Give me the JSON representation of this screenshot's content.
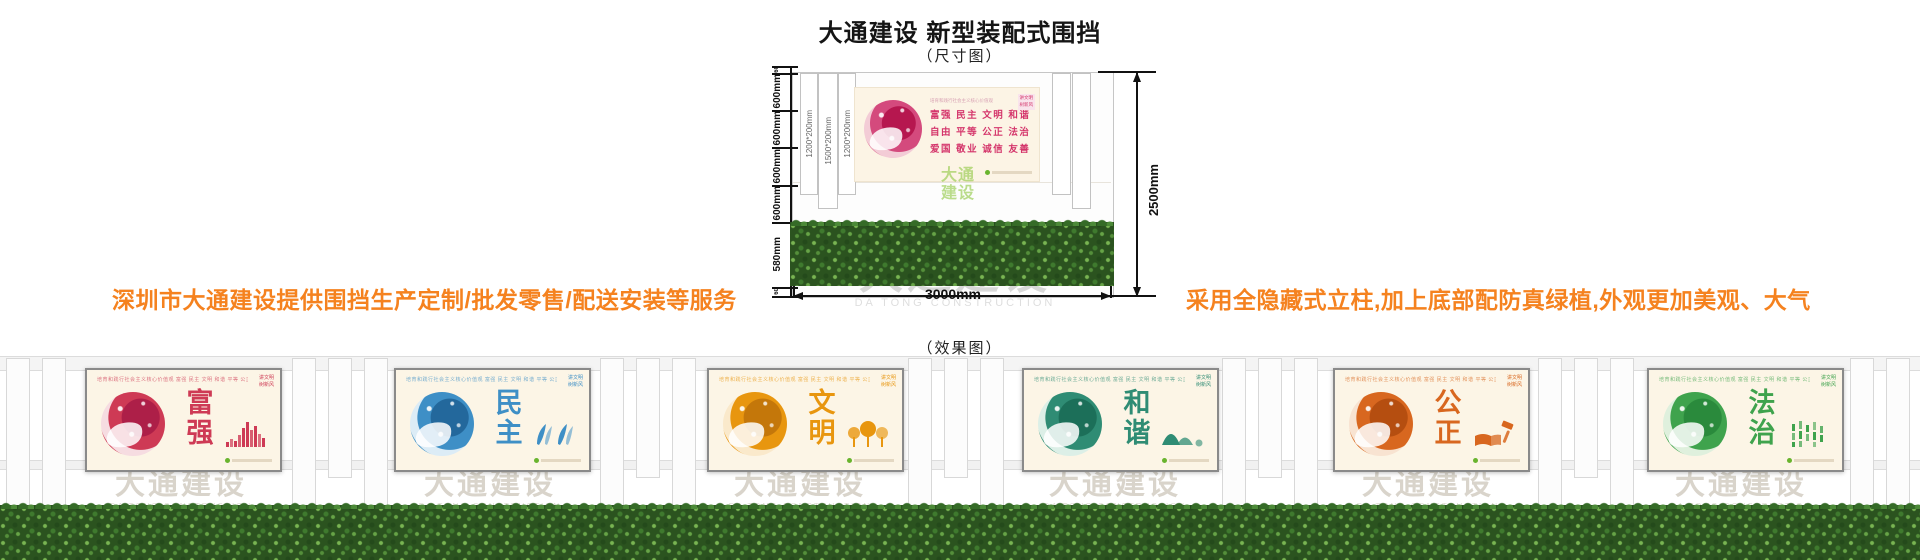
{
  "header": {
    "title": "大通建设 新型装配式围挡",
    "dimension_caption": "（尺寸图）",
    "effect_caption": "（效果图）"
  },
  "marketing": {
    "left_note": "深圳市大通建设提供围挡生产定制/批发零售/配送安装等服务",
    "right_note": "采用全隐藏式立柱,加上底部配防真绿植,外观更加美观、大气",
    "accent_color": "#F5821F"
  },
  "diagram": {
    "total_height": "2500mm",
    "total_width": "3000mm",
    "left_segments": [
      "60",
      "600mm",
      "600mm",
      "600mm",
      "600mm",
      "580mm",
      "60"
    ],
    "column_labels": [
      "1200*200mm",
      "1500*200mm",
      "1200*200mm"
    ],
    "poster": {
      "slogan_header": "培育和践行社会主义核心价值观",
      "value_rows": [
        "富强  民主  文明  和谐",
        "自由  平等  公正  法治",
        "爱国  敬业  诚信  友善"
      ],
      "chip_lines": [
        "讲文明",
        "树新风"
      ],
      "text_color": "#D4356B"
    },
    "logo_watermark": "大通建设",
    "watermark": {
      "cn": "大通建设",
      "en": "DA TONG CONSTRUCTION"
    }
  },
  "effect": {
    "watermark": {
      "cn": "大通建设",
      "en": "DA TONG CONSTRUCTION"
    },
    "slogan_header": "培育和践行社会主义核心价值观  富强 民主 文明 和谐 平等 公正 法治 爱国 敬业 诚信 友善",
    "chip_lines": [
      "讲文明",
      "树新风"
    ],
    "panels": [
      {
        "word": "富强",
        "color": "#CE3A55",
        "deep": "#AD1F48",
        "pale": "#F6DCE1",
        "icon": "city-bars"
      },
      {
        "word": "民主",
        "color": "#3E8FC6",
        "deep": "#23689C",
        "pale": "#DCECF6",
        "icon": "people"
      },
      {
        "word": "文明",
        "color": "#E8960F",
        "deep": "#C4770A",
        "pale": "#FAE9CB",
        "icon": "trees"
      },
      {
        "word": "和谐",
        "color": "#2F8C74",
        "deep": "#1C6F59",
        "pale": "#DCEFE7",
        "icon": "mountains"
      },
      {
        "word": "公正",
        "color": "#D8671F",
        "deep": "#B54E10",
        "pale": "#F8E3D1",
        "icon": "book-gavel"
      },
      {
        "word": "法治",
        "color": "#3FA34D",
        "deep": "#2A8A3C",
        "pale": "#DFF0DD",
        "icon": "bamboo"
      }
    ],
    "footer_dot_color": "#69B42E"
  }
}
